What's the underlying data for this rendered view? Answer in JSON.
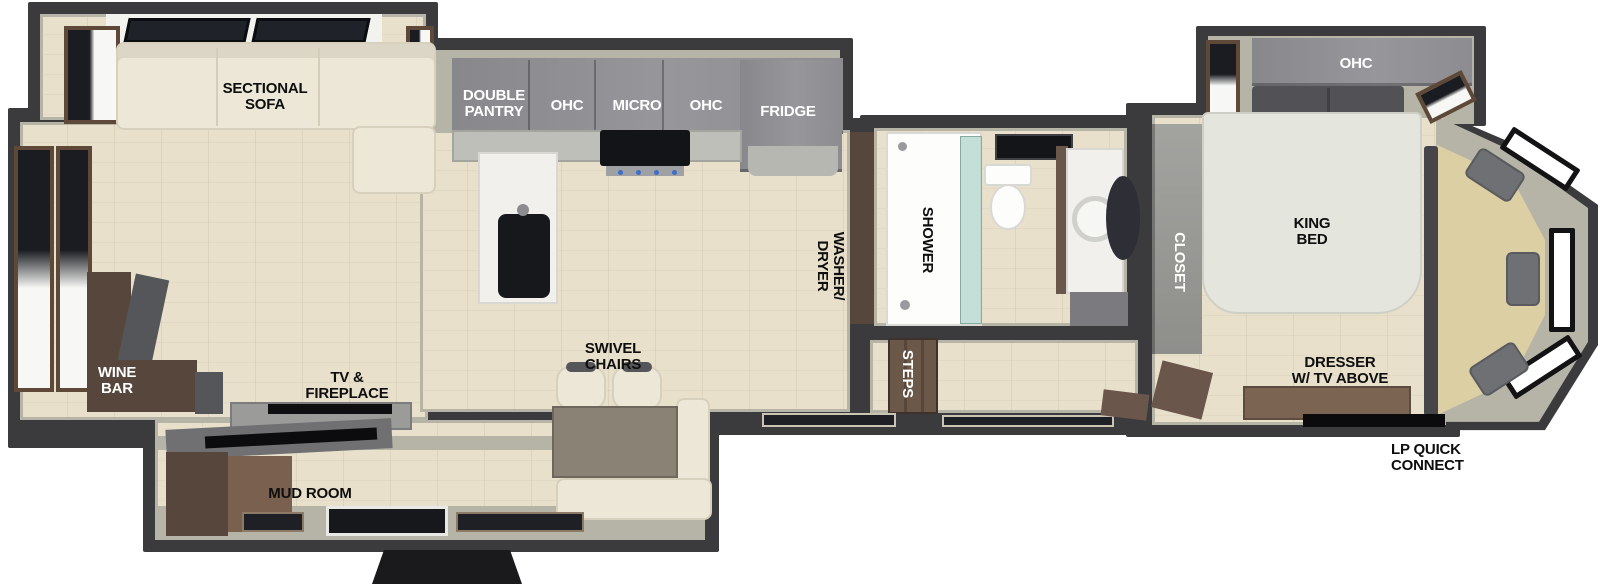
{
  "areas": {
    "living": {
      "sectional_sofa": "SECTIONAL\nSOFA",
      "wine_bar": "WINE\nBAR",
      "tv_fireplace": "TV &\nFIREPLACE",
      "swivel_chairs": "SWIVEL\nCHAIRS",
      "mud_room": "MUD ROOM"
    },
    "kitchen": {
      "double_pantry": "DOUBLE\nPANTRY",
      "ohc_left": "OHC",
      "micro": "MICRO",
      "ohc_right": "OHC",
      "fridge": "FRIDGE"
    },
    "bath_utility": {
      "washer_dryer": "WASHER/\nDRYER",
      "shower": "SHOWER",
      "steps": "STEPS"
    },
    "bedroom": {
      "closet": "CLOSET",
      "ohc": "OHC",
      "king_bed": "KING\nBED",
      "dresser_tv": "DRESSER\nW/ TV ABOVE"
    },
    "exterior": {
      "lp_quick_connect": "LP QUICK\nCONNECT"
    }
  },
  "colors": {
    "wall": "#3b3b3e",
    "floor_wood": "#e8e0cb",
    "wall_lining": "#b5b4a7",
    "cabinet_gray": "#8f8f93",
    "sofa_cream": "#ece7d6",
    "furniture_brown": "#6a564a",
    "bay_platform_khaki": "#dccfa3",
    "mattress": "#e4e5dd",
    "counter_marble": "#f1f0ed",
    "label_black": "#0e0e0e",
    "label_white": "#ffffff"
  }
}
